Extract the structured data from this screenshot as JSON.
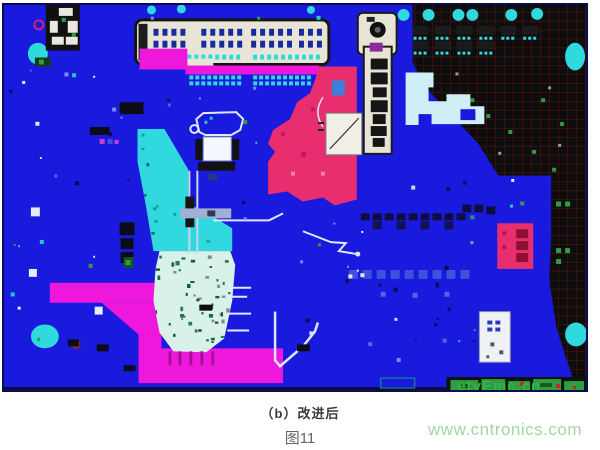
{
  "figure": {
    "caption": "（b）改进后",
    "number": "图11",
    "site_watermark": "www.cntronics.com",
    "pcb_watermark": "etyEmc.cn"
  },
  "colors": {
    "pcb_blue": "#1a1ade",
    "magenta": "#ee18dd",
    "pink": "#e82e6f",
    "cyan": "#2fd9dd",
    "pale_cyan": "#d9f2e9",
    "pale_blue": "#cfeef5",
    "beige": "#e9e5d6",
    "black_zone": "#0d0d0d",
    "grid_red": "#5f1414",
    "footer_green": "#2f9e42",
    "pcb_watermark_green": "#35b545",
    "site_watermark_green": "#a2d7a2",
    "caption_color": "#3a3a3a",
    "fignum_color": "#666666",
    "trace_white": "#dfe8ff",
    "navy_pad": "#182a9e"
  }
}
